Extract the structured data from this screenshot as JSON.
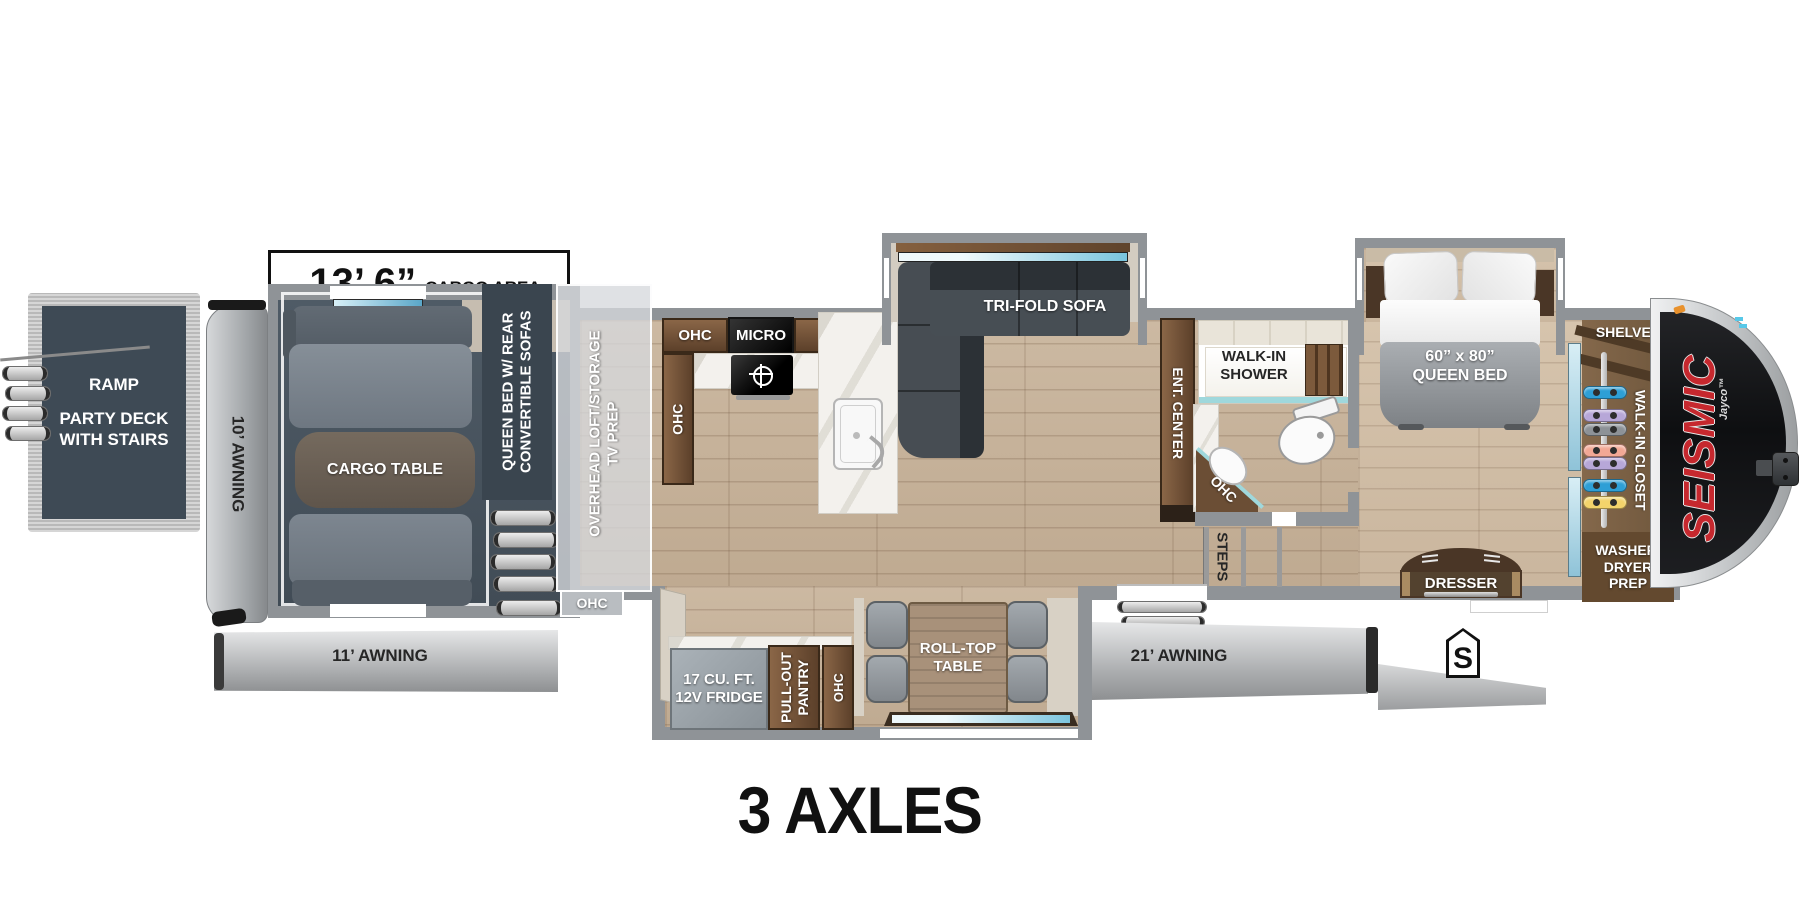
{
  "title": "3 AXLES",
  "dimension": {
    "feet": "13’ 6”",
    "suffix": "CARGO AREA"
  },
  "rear": {
    "ramp_label": "RAMP",
    "deck_line1": "PARTY DECK",
    "deck_line2": "WITH STAIRS",
    "ramp_awning": "10’ AWNING"
  },
  "garage": {
    "table": "CARGO TABLE",
    "sofa_col_line1": "QUEEN BED W/ REAR",
    "sofa_col_line2": "CONVERTIBLE SOFAS",
    "loft_line1": "OVERHEAD LOFT/STORAGE",
    "loft_line2": "TV PREP",
    "ohc": "OHC",
    "awning": "11’ AWNING"
  },
  "kitchen": {
    "ohc_top_left": "OHC",
    "micro": "MICRO",
    "ohc_top_right": "OHC",
    "ohc_side": "OHC"
  },
  "living": {
    "sofa": "TRI-FOLD SOFA",
    "ent_center": "ENT. CENTER"
  },
  "bath": {
    "shower_line1": "WALK-IN",
    "shower_line2": "SHOWER",
    "vanity_ohc": "OHC",
    "steps": "STEPS"
  },
  "bedroom": {
    "bed_line1": "60” x 80”",
    "bed_line2": "QUEEN BED",
    "dresser": "DRESSER"
  },
  "closet": {
    "shelves": "SHELVES",
    "walk_in": "WALK-IN CLOSET",
    "washer_line1": "WASHER/",
    "washer_line2": "DRYER",
    "washer_line3": "PREP",
    "hangers": [
      {
        "color": "#2e9fd6",
        "y": 386
      },
      {
        "color": "#b7a7d8",
        "y": 409
      },
      {
        "color": "#8d9297",
        "y": 423
      },
      {
        "color": "#f2a895",
        "y": 444
      },
      {
        "color": "#b7a7d8",
        "y": 457
      },
      {
        "color": "#2e9fd6",
        "y": 479
      },
      {
        "color": "#f3d36b",
        "y": 496
      }
    ]
  },
  "dinette": {
    "fridge_line1": "17 CU. FT.",
    "fridge_line2": "12V FRIDGE",
    "pantry_line1": "PULL-OUT",
    "pantry_line2": "PANTRY",
    "ohc": "OHC",
    "table_line1": "ROLL-TOP",
    "table_line2": "TABLE",
    "awning": "21’ AWNING"
  },
  "badges": {
    "spare": "S"
  },
  "brand": {
    "model": "SEISMIC",
    "maker": "Jayco™"
  },
  "colors": {
    "brand_red": "#c6282e",
    "wall_gray": "#8f9397",
    "garage_slate": "#4a5560",
    "deck_slate": "#3e4a55",
    "floor_wood": "#c7b49c",
    "cabinet_brown": "#6b4e34",
    "mirror_blue": "#a9d6e4",
    "shower_teal": "#9fd8dc",
    "awning_gray": "#b9bbbd"
  }
}
